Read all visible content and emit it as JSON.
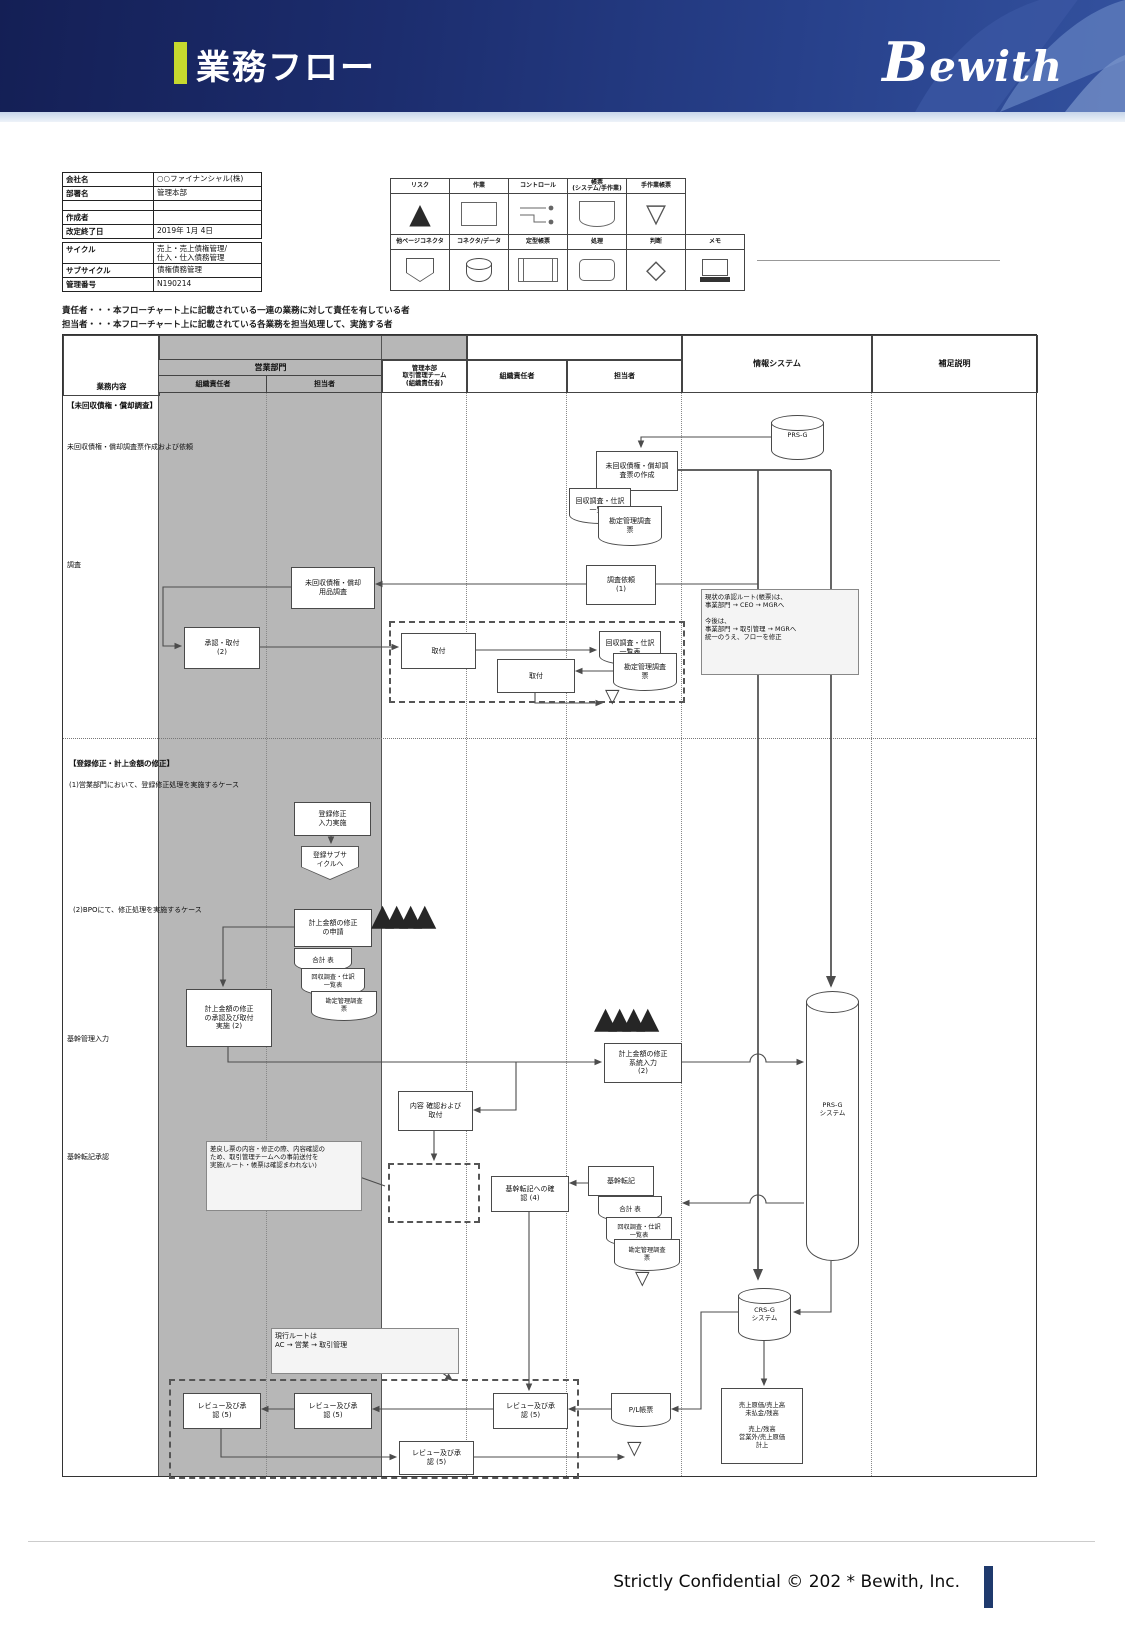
{
  "header": {
    "title": "業務フロー",
    "logo": "Bewith"
  },
  "footer": {
    "text": "Strictly Confidential © 202 *  Bewith, Inc."
  },
  "meta": {
    "t1": [
      {
        "l": "会社名",
        "v": "○○ファイナンシャル(株)"
      },
      {
        "l": "部署名",
        "v": "管理本部"
      },
      {
        "l": "",
        "v": ""
      },
      {
        "l": "作成者",
        "v": ""
      },
      {
        "l": "改定終了日",
        "v": "2019年 1月 4日"
      }
    ],
    "t2": [
      {
        "l": "サイクル",
        "v": "売上・売上債権管理/\n仕入・仕入債務管理"
      },
      {
        "l": "サブサイクル",
        "v": "債権債務管理"
      },
      {
        "l": "管理番号",
        "v": "N190214"
      }
    ]
  },
  "legend": {
    "r1": [
      {
        "label": "リスク"
      },
      {
        "label": "作業"
      },
      {
        "label": "コントロール"
      },
      {
        "label": "帳票\n(システム/手作業)"
      },
      {
        "label": "手作業帳票"
      }
    ],
    "r2": [
      {
        "label": "他ページコネクタ"
      },
      {
        "label": "コネクタ/データ"
      },
      {
        "label": "定型帳票"
      },
      {
        "label": "処理"
      },
      {
        "label": "判断"
      },
      {
        "label": "メモ"
      }
    ]
  },
  "definitions": [
    "責任者・・・本フローチャート上に記載されている一連の業務に対して責任を有している者",
    "担当者・・・本フローチャート上に記載されている各業務を担当処理して、実施する者"
  ],
  "lanes": {
    "gyomu": "業務内容",
    "dept": "営業部門",
    "org1": "組織責任者",
    "tanto1": "担当者",
    "kanri": "管理本部\n取引管理チーム\n(組織責任者)",
    "org2": "組織責任者",
    "tanto2": "担当者",
    "sys": "情報システム",
    "hosoku": "補足説明"
  },
  "rows": {
    "r1": "【未回収債権・償却調査】",
    "r2": "未回収債権・償却調査票作成および依頼",
    "r3": "調査",
    "r4": "【登録修正・計上金額の修正】",
    "r5": "(1)営業部門において、登録修正処理を実施するケース",
    "r6": "(2)BPOにて、修正処理を実施するケース",
    "r7": "基幹管理入力",
    "r8": "基幹転記承認"
  },
  "nodes": {
    "prs_db": "PRS-G",
    "create_survey": "未回収債権・償却調\n査票の作成",
    "doc_collect": "回収調査・仕訳\n一覧表",
    "doc_ledger": "勘定管理調査\n票",
    "survey_request": "調査依頼\n(1)",
    "survey_use": "未回収債権・償却\n用品調査",
    "approve_2": "承認・取付\n(2)",
    "toritsuke": "取付",
    "note_route": "現状の承認ルート(帳票)は、\n事業部門 → CEO → MGRへ\n\n今後は、\n事業部門 → 取引管理 → MGRへ\n統一のうえ、フローを修正",
    "reg_fix_input": "登録修正\n入力実施",
    "reg_subcycle": "登録サブサ\nイクルへ",
    "fix_apply": "計上金額の修正\nの申請",
    "doc_total": "合計 表",
    "fix_approve": "計上金額の修正\nの承認及び取付\n実施 (2)",
    "fix_sysinput": "計上金額の修正\n系統入力\n(2)",
    "prs_system": "PRS-G\nシステム",
    "content_check": "内容 確認および\n取付",
    "note_send": "差戻し票の内容・修正の際、内容確認の\nため、取引管理チームへの事前送付を\n実施(ルート・帳票は確認まわれない)",
    "kikan_confirm": "基幹転記への確\n認 (4)",
    "kikan_tenki": "基幹転記",
    "crs_system": "CRS-G\nシステム",
    "note_current": "現行ルートは\nAC → 営業 → 取引管理",
    "review": "レビュー及び承\n認 (5)",
    "pl_doc": "P/L帳票",
    "sales_post": "売上原価/売上高\n未払金/残高\n\n売上/残高\n営業外/売上原価\n計上"
  },
  "icons": {
    "risk_marks": "▲▲▲▲",
    "risk_mark": "▲",
    "file_mark": "▽",
    "manual_mark": "▽",
    "decision_mark": "◇"
  }
}
